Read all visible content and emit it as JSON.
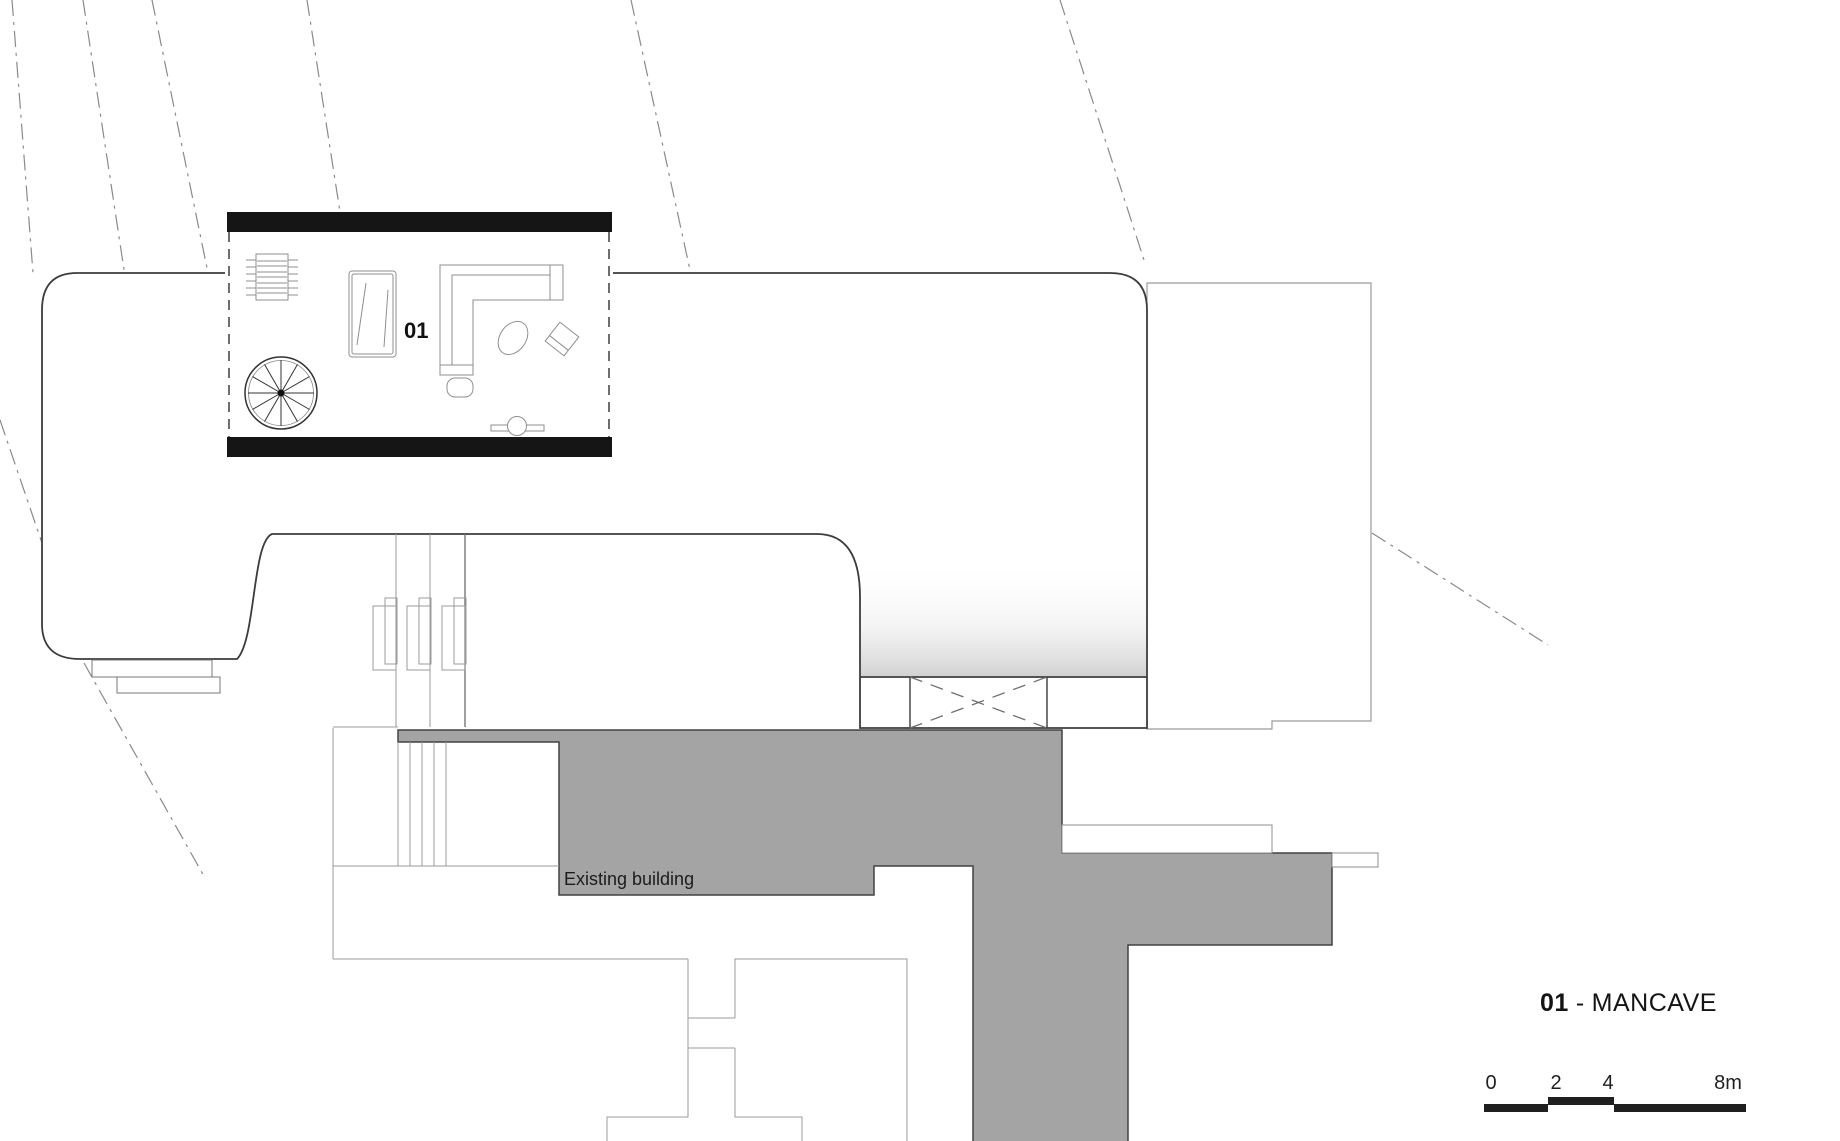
{
  "drawing": {
    "type": "architectural-floor-plan",
    "room": {
      "label": "01"
    },
    "existing_building": {
      "label": "Existing building",
      "fill_color": "#a4a4a4"
    },
    "legend": {
      "number": "01",
      "separator": "-",
      "name": "MANCAVE"
    },
    "scale_bar": {
      "ticks": [
        "0",
        "2",
        "4",
        "8m"
      ],
      "bar_color": "#1f1f1f"
    },
    "colors": {
      "background": "#ffffff",
      "new_building_wall": "#3c3c3c",
      "black_wall": "#151515",
      "thin_outline": "#9b9b9b",
      "existing_fill": "#a4a4a4",
      "contour_line": "#8a8a8a",
      "gradient_end": "#d2d2d2"
    },
    "icons": [
      "spiral-staircase-icon",
      "radiator-icon",
      "desk-icon",
      "corner-sofa-icon",
      "pouf-icon",
      "beanbag-icon",
      "lounge-chair-icon",
      "tv-console-icon"
    ]
  }
}
